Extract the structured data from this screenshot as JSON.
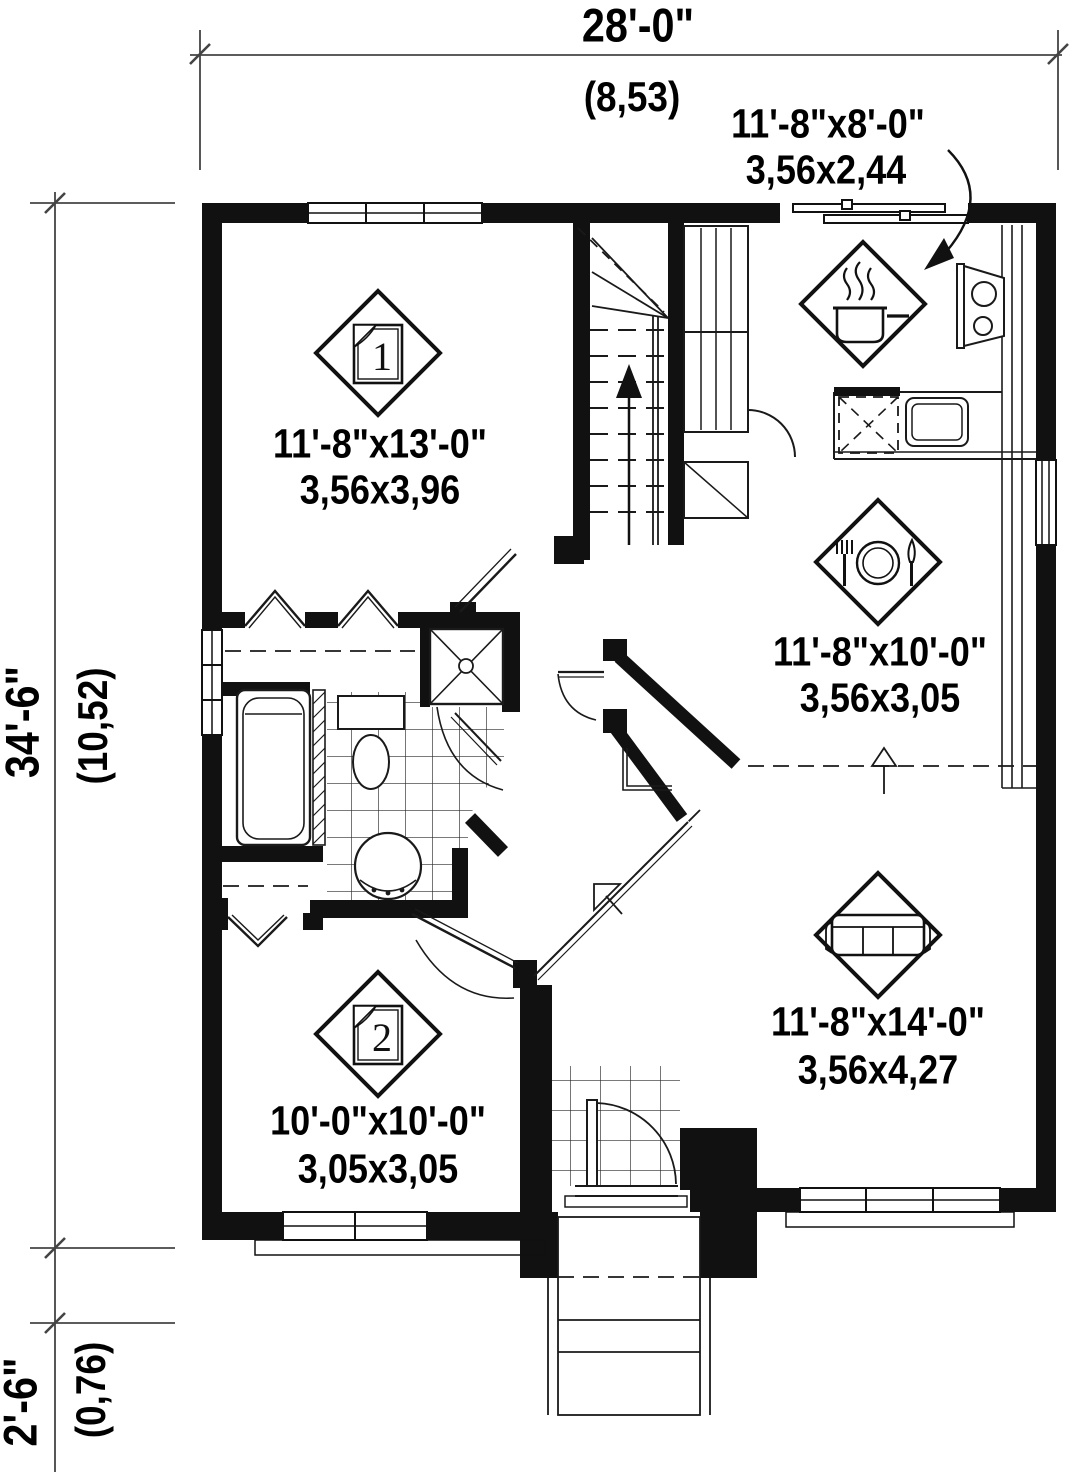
{
  "plan": {
    "dimensions": {
      "overall_width": {
        "imperial": "28'-0\"",
        "metric": "(8,53)"
      },
      "overall_height": {
        "imperial": "34'-6\"",
        "metric": "(10,52)"
      },
      "porch_depth": {
        "imperial": "2'-6\"",
        "metric": "(0,76)"
      }
    },
    "rooms": [
      {
        "id": "bedroom-1",
        "icon": "bed-icon",
        "badge": "1",
        "imperial": "11'-8\"x13'-0\"",
        "metric": "3,56x3,96"
      },
      {
        "id": "kitchen",
        "icon": "cooking-pot-icon",
        "badge": "",
        "imperial": "11'-8\"x8'-0\"",
        "metric": "3,56x2,44"
      },
      {
        "id": "dining-room",
        "icon": "cutlery-icon",
        "badge": "",
        "imperial": "11'-8\"x10'-0\"",
        "metric": "3,56x3,05"
      },
      {
        "id": "living-room",
        "icon": "sofa-icon",
        "badge": "",
        "imperial": "11'-8\"x14'-0\"",
        "metric": "3,56x4,27"
      },
      {
        "id": "bedroom-2",
        "icon": "bed-icon",
        "badge": "2",
        "imperial": "10'-0\"x10'-0\"",
        "metric": "3,05x3,05"
      }
    ],
    "colors": {
      "wall": "#111111",
      "line": "#1a1a1a",
      "dim_line": "#444444"
    }
  }
}
